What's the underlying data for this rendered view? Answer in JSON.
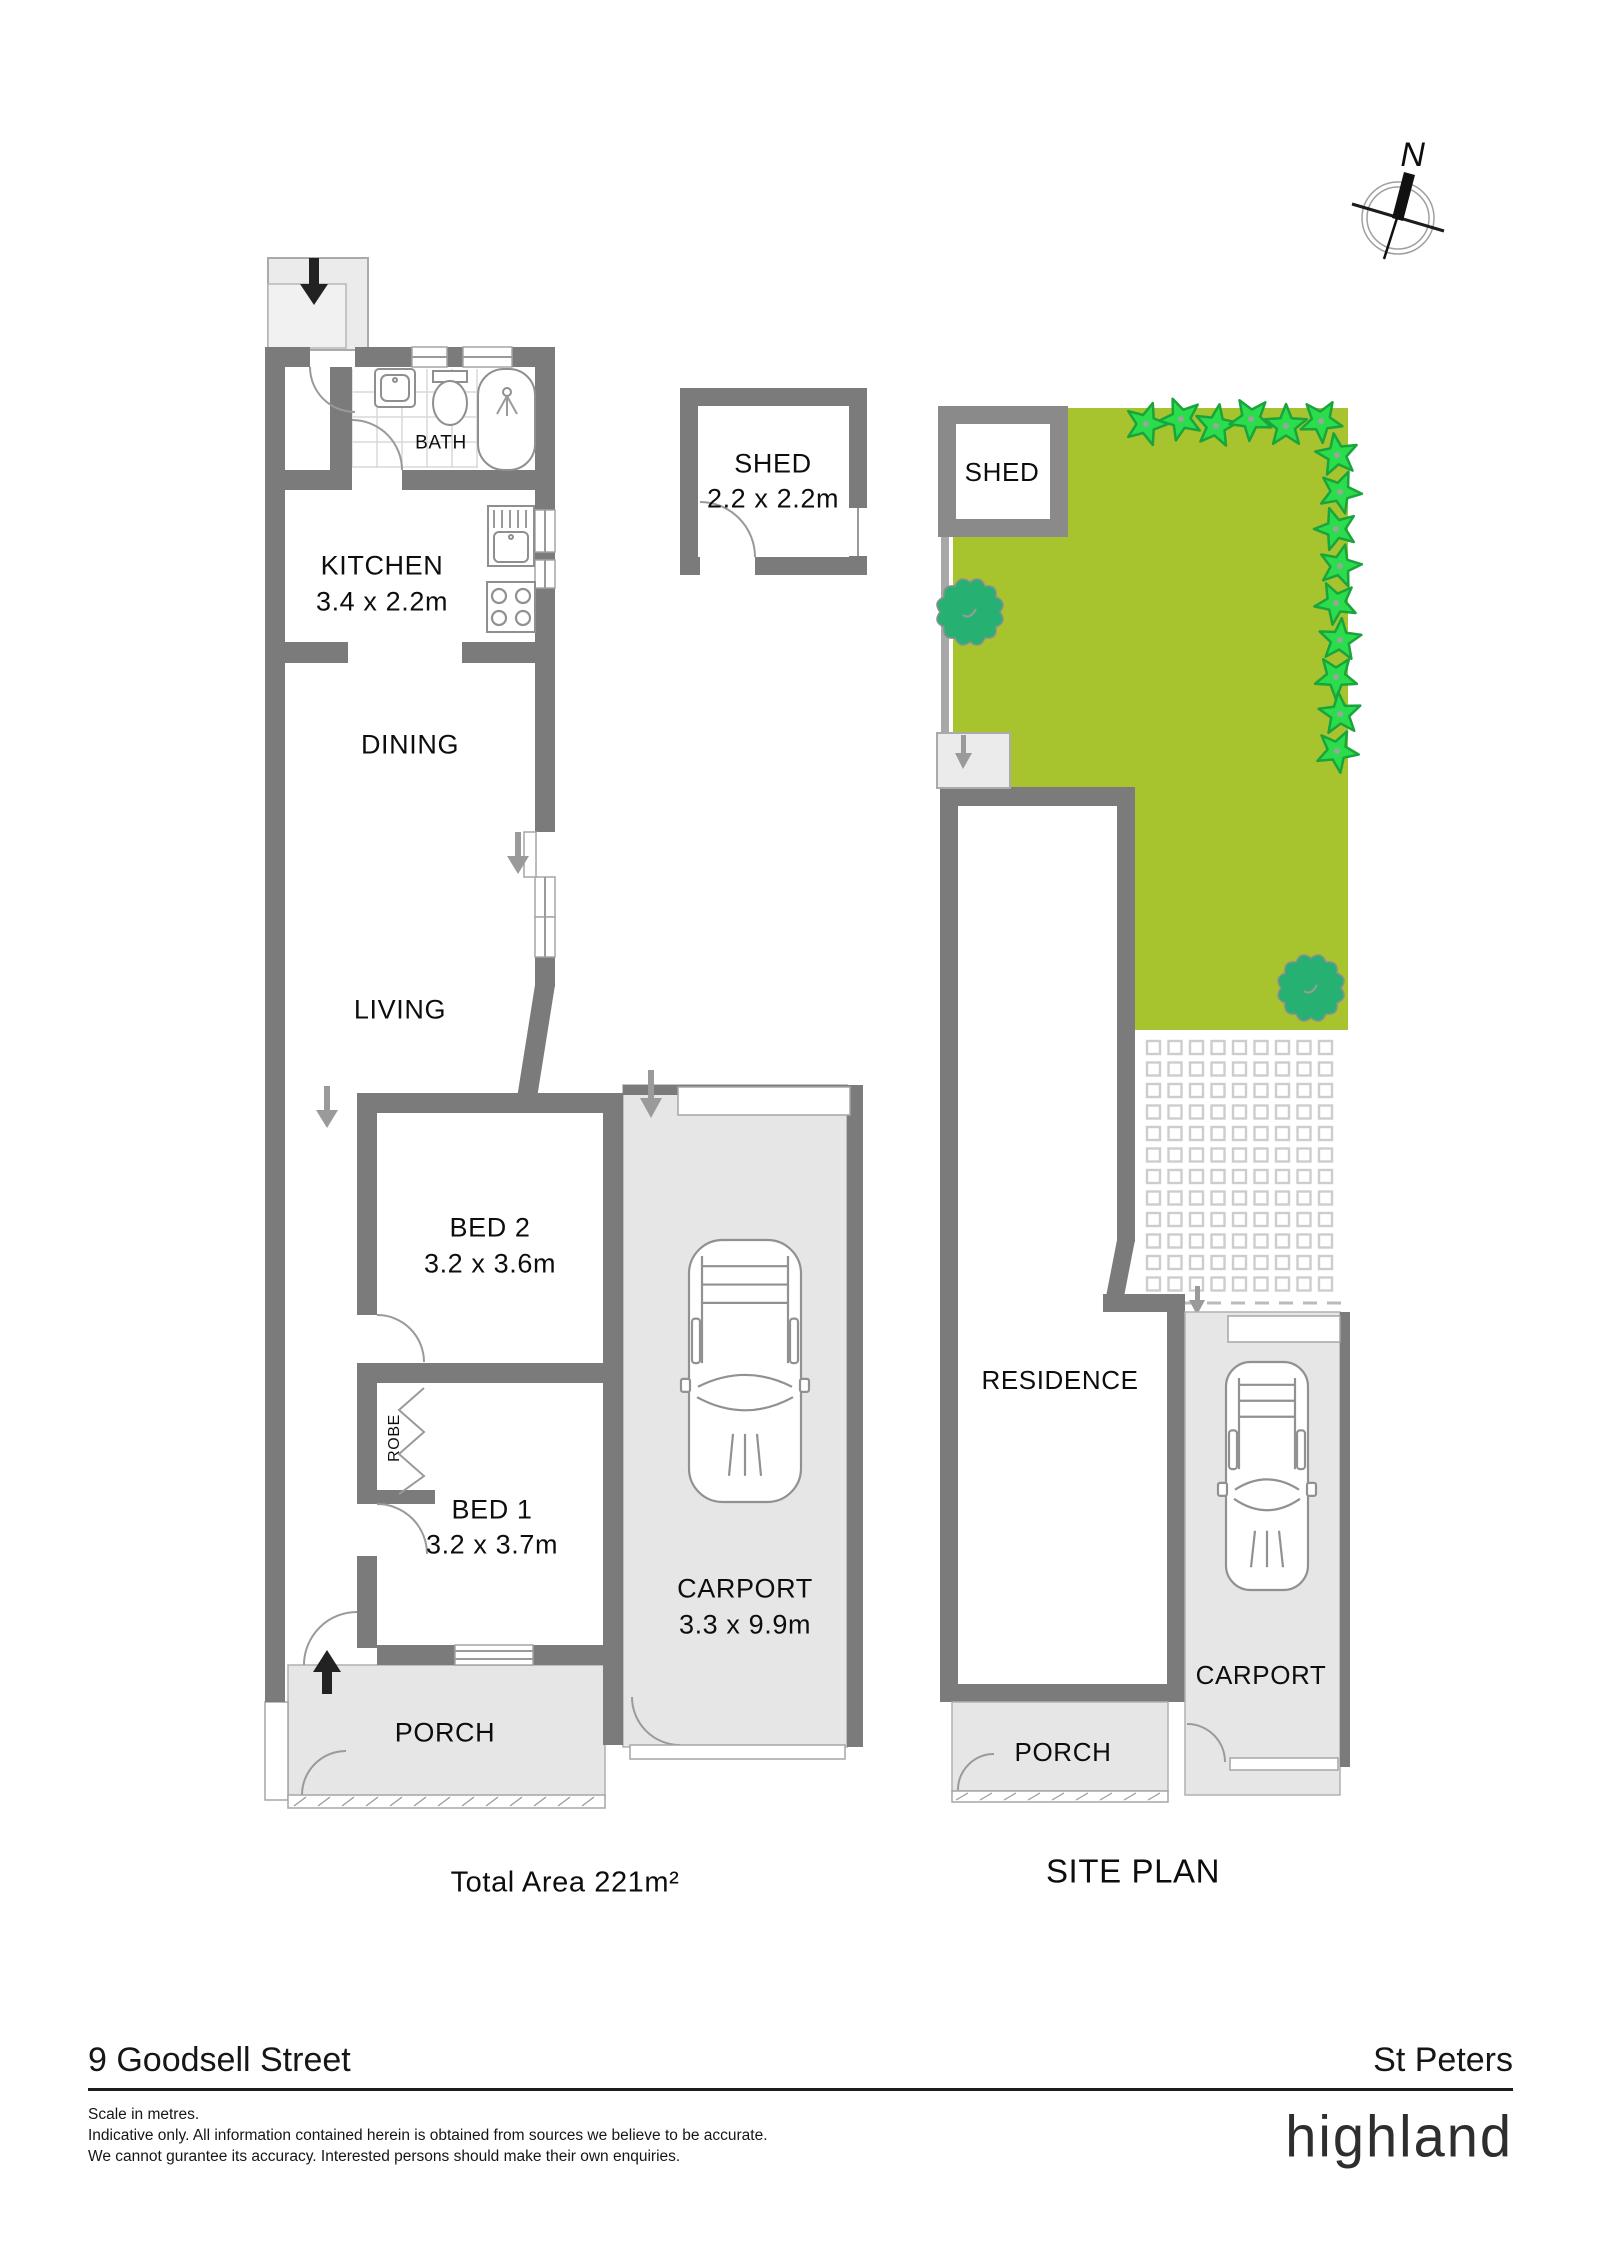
{
  "compass": {
    "label": "N"
  },
  "floor_plan": {
    "rooms": {
      "bath": {
        "label": "BATH"
      },
      "kitchen": {
        "label": "KITCHEN",
        "dims": "3.4 x 2.2m"
      },
      "dining": {
        "label": "DINING"
      },
      "dining_living_dims": "3.4 x 6.2m",
      "living": {
        "label": "LIVING"
      },
      "bed2": {
        "label": "BED 2",
        "dims": "3.2 x 3.6m"
      },
      "robe": {
        "label": "ROBE"
      },
      "bed1": {
        "label": "BED 1",
        "dims": "3.2 x 3.7m"
      },
      "porch": {
        "label": "PORCH"
      },
      "carport": {
        "label": "CARPORT",
        "dims": "3.3 x 9.9m"
      },
      "shed": {
        "label": "SHED",
        "dims": "2.2 x 2.2m"
      }
    },
    "total_area": "Total Area  221m²"
  },
  "site_plan": {
    "title": "SITE PLAN",
    "labels": {
      "shed": "SHED",
      "residence": "RESIDENCE",
      "porch": "PORCH",
      "carport": "CARPORT"
    }
  },
  "footer": {
    "address": "9 Goodsell Street",
    "suburb": "St Peters",
    "scale_note": "Scale in metres.",
    "disclaimer_line1": "Indicative only. All information contained herein is obtained from sources we believe to be accurate.",
    "disclaimer_line2": "We cannot gurantee its accuracy. Interested persons should make their own enquiries.",
    "brand": "highland"
  },
  "colors": {
    "wall": "#7b7b7b",
    "paved": "#e6e6e6",
    "grass": "#a7c42e",
    "plant": "#2bdc4d",
    "plant_outline": "#1aa43c",
    "tree": "#26b173",
    "text": "#0d0d0d"
  }
}
